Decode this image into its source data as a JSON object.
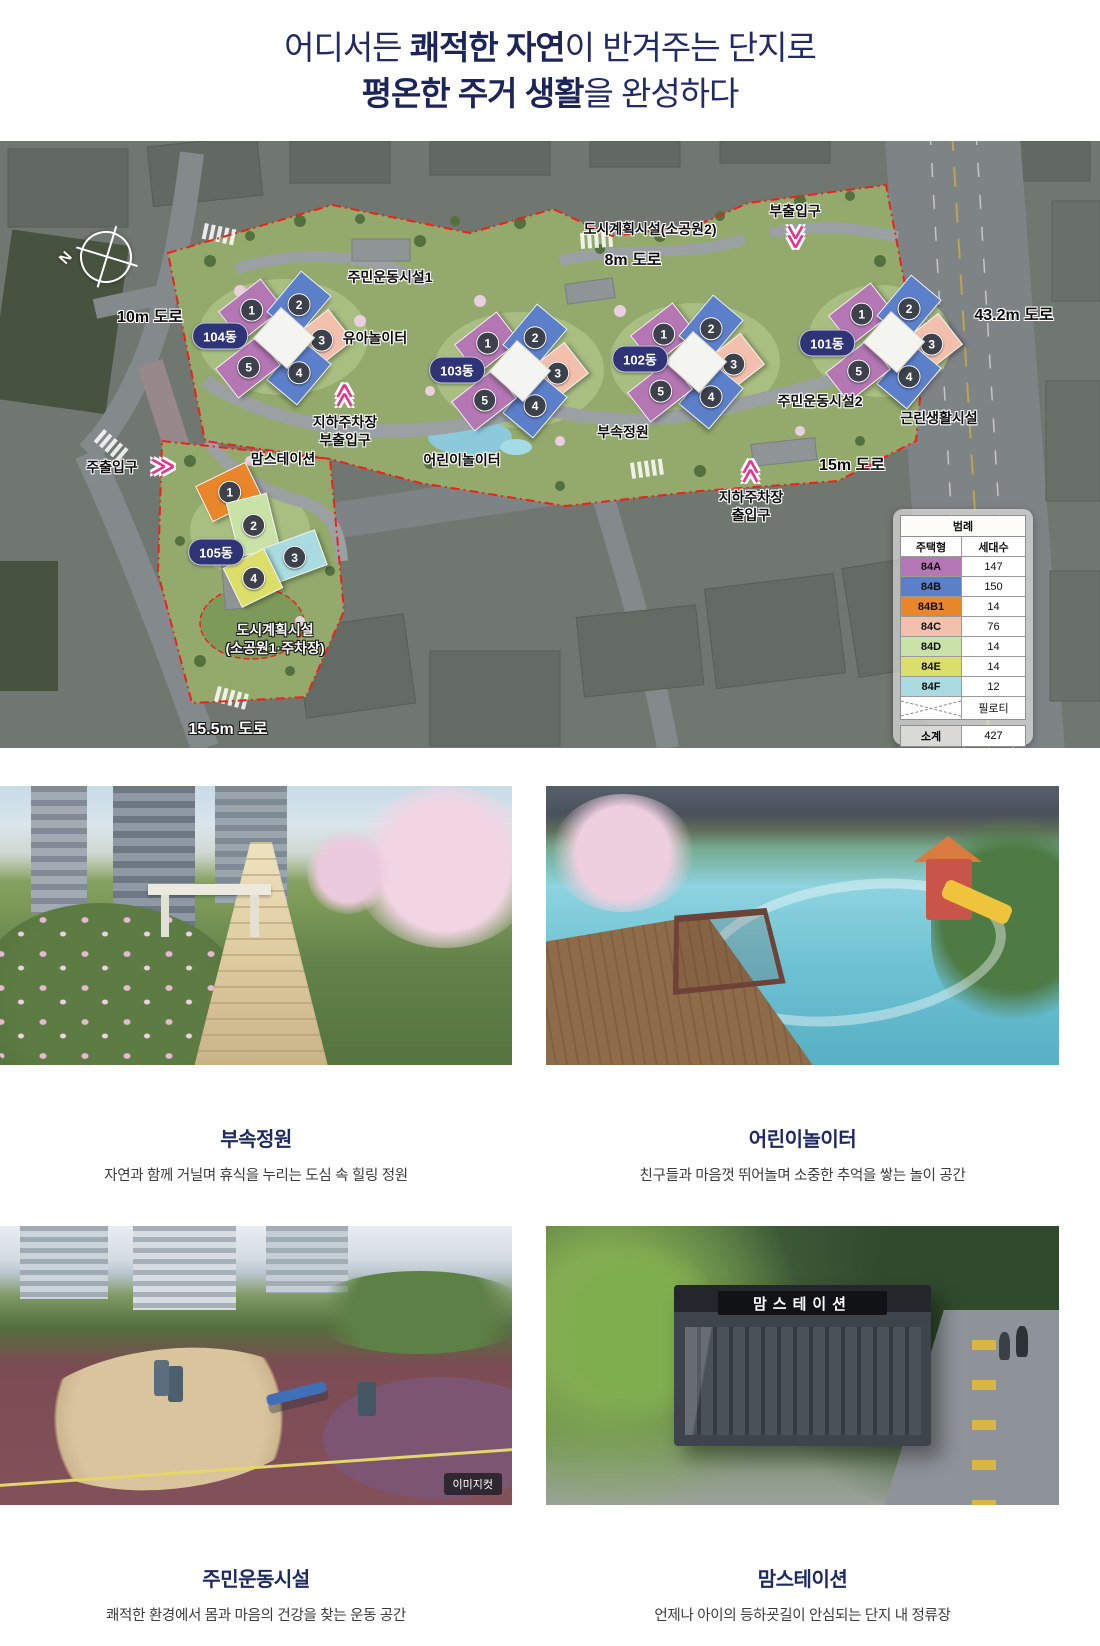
{
  "header": {
    "line1_pre": "어디서든 ",
    "line1_bold": "쾌적한 자연",
    "line1_post": "이 반겨주는 단지로",
    "line2_bold": "평온한 주거 생활",
    "line2_post": "을 완성하다"
  },
  "site_plan": {
    "compass": "N",
    "roads": {
      "r8": "8m 도로",
      "r10": "10m 도로",
      "r43": "43.2m 도로",
      "r15": "15m 도로",
      "r155": "15.5m 도로"
    },
    "facilities": {
      "sogongwon2": "도시계획시설(소공원2)",
      "sports1": "주민운동시설1",
      "sports2": "주민운동시설2",
      "kids_play": "유아놀이터",
      "children_play": "어린이놀이터",
      "garden": "부속정원",
      "neighborhood": "근린생활시설",
      "momstation": "맘스테이션",
      "sogongwon1_line1": "도시계획시설",
      "sogongwon1_line2": "(소공원1·주차장)"
    },
    "entrances": {
      "main": "주출입구",
      "sub": "부출입구",
      "parking_sub_line1": "지하주차장",
      "parking_sub_line2": "부출입구",
      "parking_main_line1": "지하주차장",
      "parking_main_line2": "출입구"
    },
    "buildings": [
      {
        "name": "104동",
        "units": [
          "1",
          "2",
          "3",
          "4",
          "5"
        ]
      },
      {
        "name": "103동",
        "units": [
          "1",
          "2",
          "3",
          "4",
          "5"
        ]
      },
      {
        "name": "102동",
        "units": [
          "1",
          "2",
          "3",
          "4",
          "5"
        ]
      },
      {
        "name": "101동",
        "units": [
          "1",
          "2",
          "3",
          "4",
          "5"
        ]
      },
      {
        "name": "105동",
        "units": [
          "1",
          "2",
          "3",
          "4"
        ]
      }
    ],
    "legend": {
      "title": "범례",
      "col_type": "주택형",
      "col_count": "세대수",
      "rows": [
        {
          "type": "84A",
          "count": "147",
          "color": "#b477b4"
        },
        {
          "type": "84B",
          "count": "150",
          "color": "#5c7fca"
        },
        {
          "type": "84B1",
          "count": "14",
          "color": "#e9862c"
        },
        {
          "type": "84C",
          "count": "76",
          "color": "#f4c0ae"
        },
        {
          "type": "84D",
          "count": "14",
          "color": "#c9e2a8"
        },
        {
          "type": "84E",
          "count": "14",
          "color": "#dbdf69"
        },
        {
          "type": "84F",
          "count": "12",
          "color": "#a9dbe0"
        }
      ],
      "piloti": "필로티",
      "subtotal_label": "소계",
      "subtotal_value": "427"
    }
  },
  "cards": [
    {
      "title": "부속정원",
      "desc": "자연과 함께 거닐며 휴식을 누리는 도심 속 힐링 정원"
    },
    {
      "title": "어린이놀이터",
      "desc": "친구들과 마음껏 뛰어놀며 소중한 추억을 쌓는 놀이 공간"
    },
    {
      "title": "주민운동시설",
      "desc": "쾌적한 환경에서 몸과 마음의 건강을 찾는 운동 공간",
      "watermark": "이미지컷"
    },
    {
      "title": "맘스테이션",
      "desc": "언제나 아이의 등하굣길이 안심되는 단지 내 정류장",
      "sign": "맘스테이션"
    }
  ],
  "colors": {
    "title_navy": "#232b66",
    "pill_navy": "#2e3476",
    "arrow_pink": "#e8348e",
    "boundary_red": "#f01f1a",
    "unit_circle": "#3c414b"
  }
}
